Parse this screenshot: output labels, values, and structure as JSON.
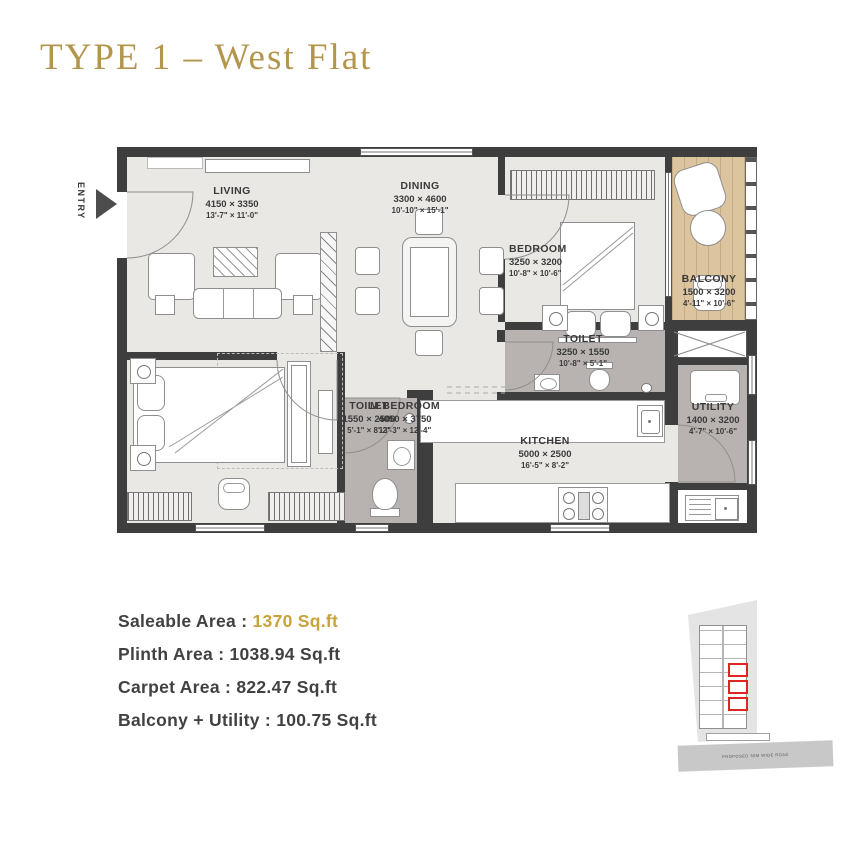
{
  "title": "TYPE 1 – West Flat",
  "entry_label": "ENTRY",
  "rooms": {
    "living": {
      "name": "LIVING",
      "mm": "4150 × 3350",
      "ft": "13'-7\" × 11'-0\""
    },
    "dining": {
      "name": "DINING",
      "mm": "3300 × 4600",
      "ft": "10'-10\" × 15'-1\""
    },
    "bedroom": {
      "name": "BEDROOM",
      "mm": "3250 × 3200",
      "ft": "10'-8\" × 10'-6\""
    },
    "balcony": {
      "name": "BALCONY",
      "mm": "1500 × 3200",
      "ft": "4'-11\" × 10'-6\""
    },
    "toilet1": {
      "name": "TOILET",
      "mm": "3250 × 1550",
      "ft": "10'-8\" × 5'-1\""
    },
    "utility": {
      "name": "UTILITY",
      "mm": "1400 × 3200",
      "ft": "4'-7\" × 10'-6\""
    },
    "mbedroom": {
      "name": "M.BEDROOM",
      "mm": "4050 × 3750",
      "ft": "13'-3\" × 12'-4\""
    },
    "toilet2": {
      "name": "TOILET",
      "mm": "1550 × 2500",
      "ft": "5'-1\" × 8'-2\""
    },
    "kitchen": {
      "name": "KITCHEN",
      "mm": "5000 × 2500",
      "ft": "16'-5\" × 8'-2\""
    }
  },
  "areas": [
    {
      "label": "Saleable Area : ",
      "value": "1370 Sq.ft"
    },
    {
      "label": "Plinth Area : ",
      "value": "1038.94 Sq.ft"
    },
    {
      "label": "Carpet Area : ",
      "value": "822.47 Sq.ft"
    },
    {
      "label": "Balcony + Utility : ",
      "value": "100.75 Sq.ft"
    }
  ],
  "key_plan": {
    "road_label": "PROPOSED 30M WIDE ROAD"
  },
  "colors": {
    "title_gold": "#b3954d",
    "value_gold": "#c9a23c",
    "wall": "#3e3e3e",
    "floor_light": "#e9e8e5",
    "floor_dark": "#b8b3b0",
    "balcony_wood": "#dcc49e",
    "highlight_red": "#e02424",
    "text_dark": "#414141"
  }
}
